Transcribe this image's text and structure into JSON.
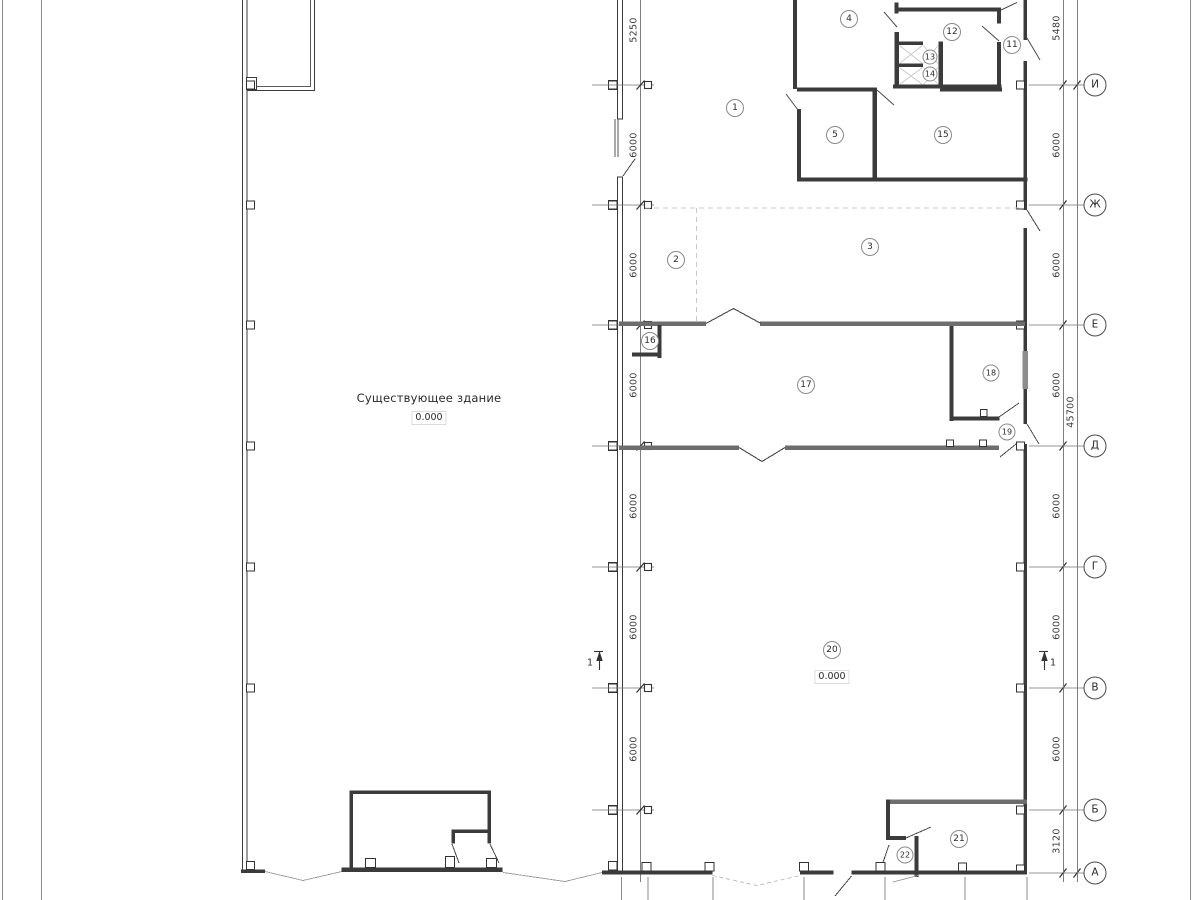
{
  "labels": {
    "existing_building": "Существующее здание",
    "level_existing": "0.000",
    "level_hall": "0.000",
    "section_left": "1",
    "section_right": "1"
  },
  "rooms": [
    {
      "n": "1",
      "x": 735,
      "y": 108,
      "d": 16
    },
    {
      "n": "2",
      "x": 676,
      "y": 260,
      "d": 16
    },
    {
      "n": "3",
      "x": 870,
      "y": 247,
      "d": 16
    },
    {
      "n": "4",
      "x": 849,
      "y": 19,
      "d": 16
    },
    {
      "n": "5",
      "x": 835,
      "y": 135,
      "d": 16
    },
    {
      "n": "11",
      "x": 1012,
      "y": 45,
      "d": 16
    },
    {
      "n": "12",
      "x": 952,
      "y": 32,
      "d": 16
    },
    {
      "n": "13",
      "x": 930,
      "y": 57,
      "d": 13
    },
    {
      "n": "14",
      "x": 930,
      "y": 74,
      "d": 13
    },
    {
      "n": "15",
      "x": 943,
      "y": 135,
      "d": 16
    },
    {
      "n": "16",
      "x": 650,
      "y": 341,
      "d": 16
    },
    {
      "n": "17",
      "x": 806,
      "y": 385,
      "d": 16
    },
    {
      "n": "18",
      "x": 991,
      "y": 373,
      "d": 15
    },
    {
      "n": "19",
      "x": 1007,
      "y": 432,
      "d": 15
    },
    {
      "n": "20",
      "x": 832,
      "y": 650,
      "d": 16
    },
    {
      "n": "21",
      "x": 959,
      "y": 839,
      "d": 16
    },
    {
      "n": "22",
      "x": 905,
      "y": 855,
      "d": 15
    }
  ],
  "axes": [
    {
      "label": "И",
      "y": 85
    },
    {
      "label": "Ж",
      "y": 205
    },
    {
      "label": "Е",
      "y": 325
    },
    {
      "label": "Д",
      "y": 446
    },
    {
      "label": "Г",
      "y": 567
    },
    {
      "label": "В",
      "y": 688
    },
    {
      "label": "Б",
      "y": 810
    },
    {
      "label": "А",
      "y": 873
    }
  ],
  "dims_left": [
    {
      "t": "5250",
      "y": 30
    },
    {
      "t": "6000",
      "y": 145
    },
    {
      "t": "6000",
      "y": 265
    },
    {
      "t": "6000",
      "y": 385
    },
    {
      "t": "6000",
      "y": 506
    },
    {
      "t": "6000",
      "y": 627
    },
    {
      "t": "6000",
      "y": 749
    }
  ],
  "dims_right": [
    {
      "t": "5480",
      "y": 28
    },
    {
      "t": "6000",
      "y": 145
    },
    {
      "t": "6000",
      "y": 265
    },
    {
      "t": "6000",
      "y": 385
    },
    {
      "t": "6000",
      "y": 506
    },
    {
      "t": "6000",
      "y": 627
    },
    {
      "t": "6000",
      "y": 749
    },
    {
      "t": "3120",
      "y": 841
    }
  ],
  "dim_overall": {
    "t": "45700",
    "x": 1071,
    "y": 412
  },
  "colors": {
    "wall_dark": "#3b3b3b",
    "wall_gray": "#6d6d6d",
    "dim_line": "#707070",
    "light_line": "#c9c9c9",
    "text": "#2b2b2b"
  }
}
